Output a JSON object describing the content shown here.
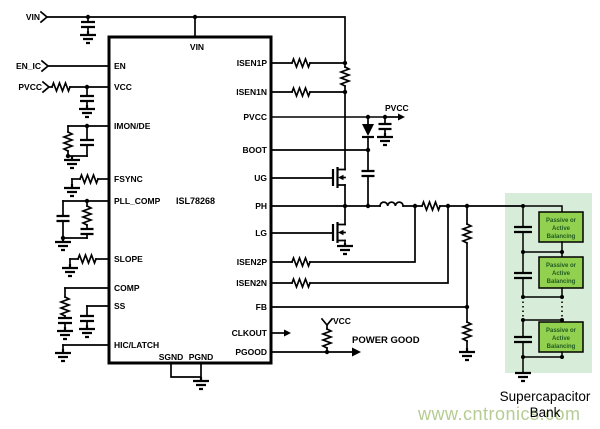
{
  "schematic": {
    "inputs": {
      "vin": "VIN",
      "en_ic": "EN_IC",
      "pvcc": "PVCC"
    },
    "ic": {
      "part_number": "ISL78268",
      "top_pin": "VIN",
      "bottom_pins": [
        "SGND",
        "PGND"
      ],
      "left_pins": [
        "EN",
        "VCC",
        "IMON/DE",
        "FSYNC",
        "PLL_COMP",
        "SLOPE",
        "COMP",
        "SS",
        "HIC/LATCH"
      ],
      "right_pins": [
        "ISEN1P",
        "ISEN1N",
        "PVCC",
        "BOOT",
        "UG",
        "PH",
        "LG",
        "ISEN2P",
        "ISEN2N",
        "FB",
        "CLKOUT",
        "PGOOD"
      ]
    },
    "outputs": {
      "pvcc": "PVCC",
      "vcc": "VCC",
      "power_good": "POWER GOOD"
    },
    "supercap_bank": {
      "label_line1": "Supercapacitor",
      "label_line2": "Bank",
      "balancing_box_lines": [
        "Passive or",
        "Active",
        "Balancing"
      ]
    }
  },
  "watermark": "www.cntronics.com",
  "colors": {
    "wire": "#000000",
    "panel_bg": "#d7ecd9",
    "box_fill": "#92d050",
    "box_text": "#215c21",
    "watermark": "#b5cc92"
  }
}
